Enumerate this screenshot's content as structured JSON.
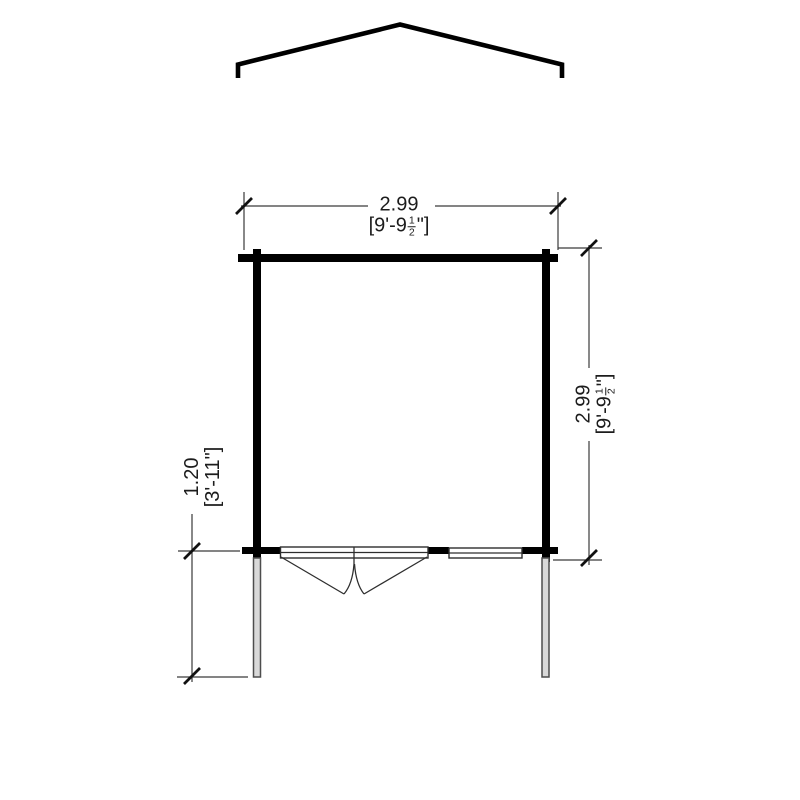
{
  "drawing": {
    "kind": "floor-plan-with-roof-profile"
  },
  "dimensions": {
    "width": {
      "metric": "2.99",
      "imperial_prefix": "[9'-9",
      "fraction_numerator": "1",
      "fraction_denominator": "2",
      "imperial_suffix": "\"]"
    },
    "depth": {
      "metric": "2.99",
      "imperial_prefix": "[9'-9",
      "fraction_numerator": "1",
      "fraction_denominator": "2",
      "imperial_suffix": "\"]"
    },
    "canopy": {
      "metric": "1.20",
      "imperial": "[3'-11\"]"
    }
  },
  "colors": {
    "background": "#ffffff",
    "wall": "#000000",
    "thin_line": "#2e2e2e",
    "dimension_line": "#3a3a3a",
    "text": "#1c1c1c",
    "post_fill": "#d9d9d9",
    "post_stroke": "#4d4d4d"
  }
}
